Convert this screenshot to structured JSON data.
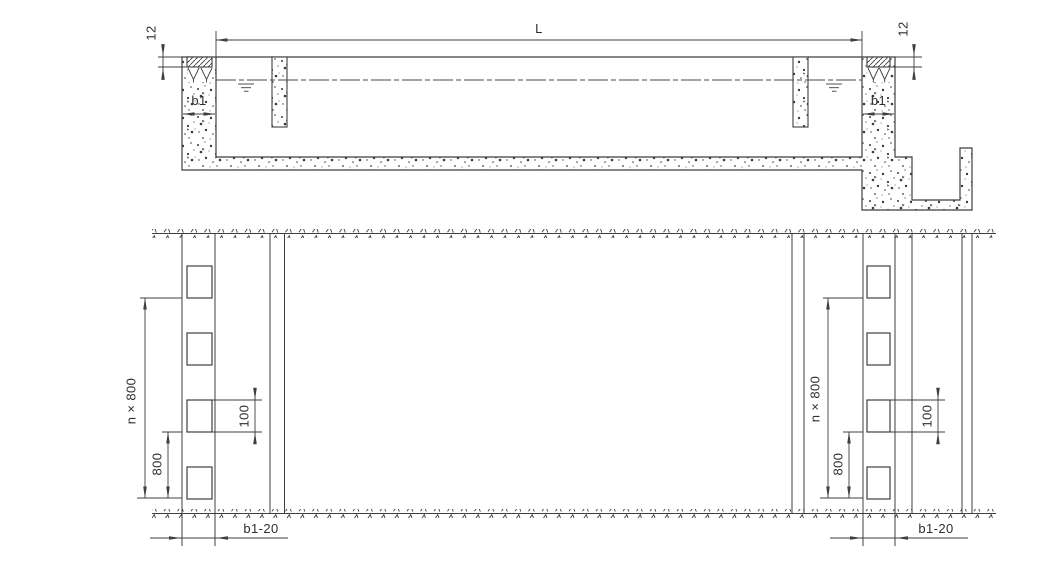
{
  "section": {
    "length": "L",
    "coping_height_left": "12",
    "coping_height_right": "12",
    "wall_width_left": "b1",
    "wall_width_right": "b1"
  },
  "plan": {
    "left": {
      "total_spacing": "n × 800",
      "spacing": "800",
      "opening": "100",
      "wall": "b1-20"
    },
    "right": {
      "total_spacing": "n × 800",
      "spacing": "800",
      "opening": "100",
      "wall": "b1-20"
    }
  }
}
